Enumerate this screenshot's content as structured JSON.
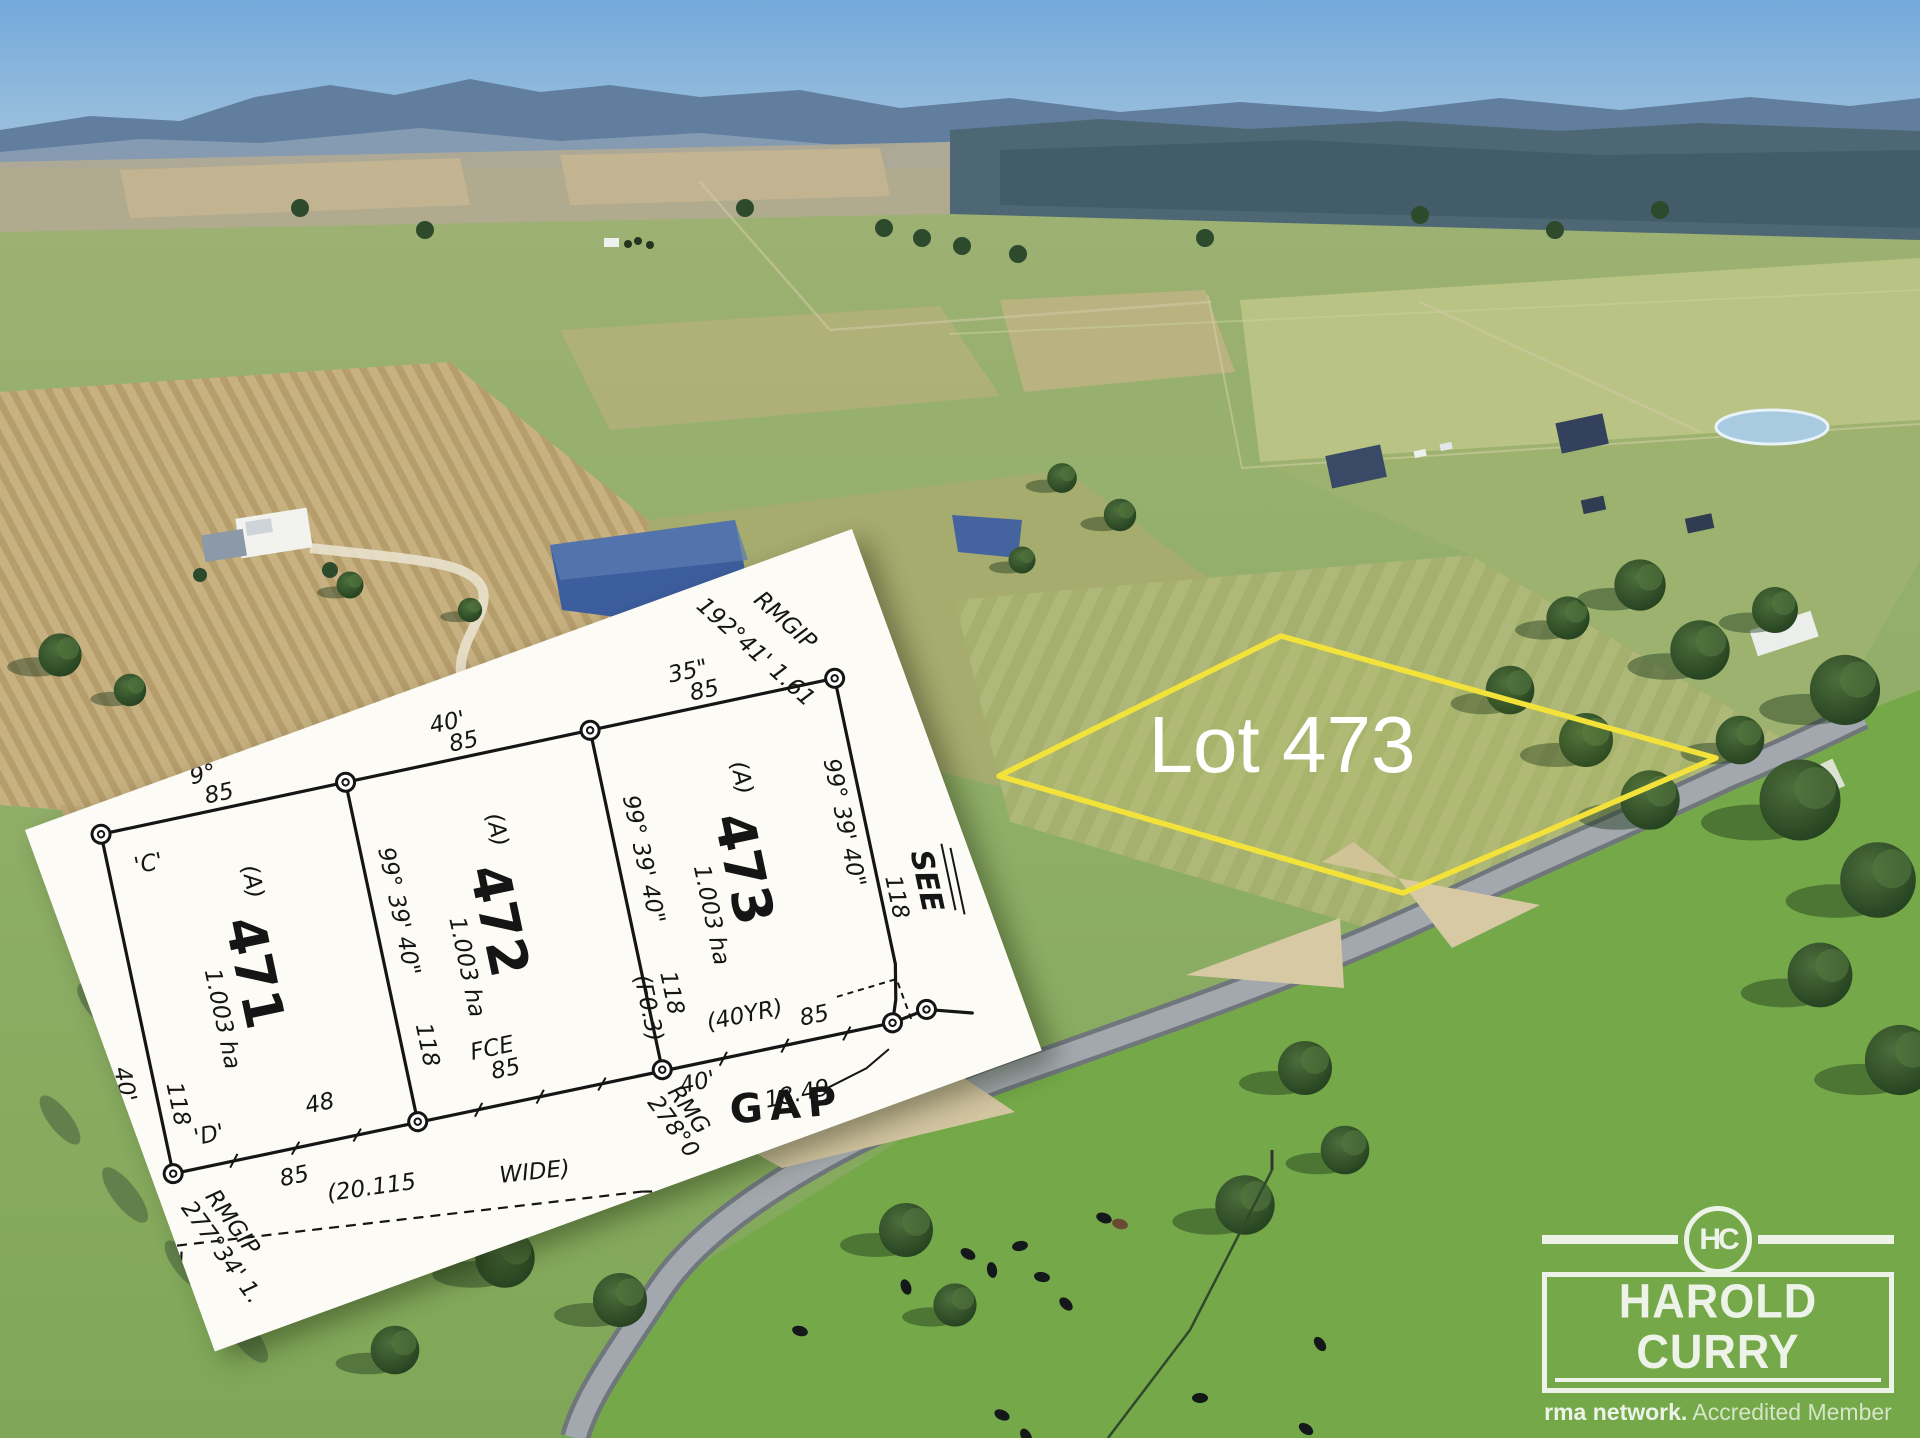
{
  "image": {
    "kind": "real-estate aerial marketing photo",
    "width": 1920,
    "height": 1438
  },
  "aerial": {
    "lot_label": "Lot 473",
    "outline_color": "#f3e23a",
    "sky_color": "#74a9db",
    "mountain_color": "#5f7a9b",
    "field_green": "#8fae67",
    "wheat_color": "#c7b181",
    "road_color": "#9aa0a4",
    "dam_color": "#3d5e9e"
  },
  "plan": {
    "paper_color": "#fcfbf6",
    "ink_color": "#151515",
    "corner_c": "'C'",
    "corner_d": "'D'",
    "top_bearing_1": "9°",
    "top_bearing_2": "40'",
    "top_bearing_3": "35\"",
    "frontage": "85",
    "depth": "118",
    "side_bearing": "99° 39' 40\"",
    "left_outer": "40'",
    "lots": [
      {
        "number": "471",
        "code": "(A)",
        "area": "1.003 ha",
        "note": "48"
      },
      {
        "number": "472",
        "code": "(A)",
        "area": "1.003 ha",
        "note": "FCE",
        "note2": "85"
      },
      {
        "number": "473",
        "code": "(A)",
        "area": "1.003 ha",
        "note": "(40YR)",
        "note2": "85"
      }
    ],
    "rm_top_right_1": "RMGIP",
    "rm_top_right_2": "192°41' 1.61",
    "rm_bottom_left_1": "RMGIP",
    "rm_bottom_left_2": "277°34' 1.",
    "rm_mid_1": "RMG",
    "rm_mid_2": "278°0",
    "road_width_1": "(20.115",
    "road_width_2": "WIDE)",
    "road_name": "GAP",
    "corner_note": "40'",
    "corner_offset": "18.49",
    "fence_note": "(F0.3)",
    "see_note": "SEE"
  },
  "logo": {
    "monogram": "HC",
    "name": "HAROLD CURRY",
    "tagline_bold": "rma network.",
    "tagline_rest": "Accredited Member"
  }
}
